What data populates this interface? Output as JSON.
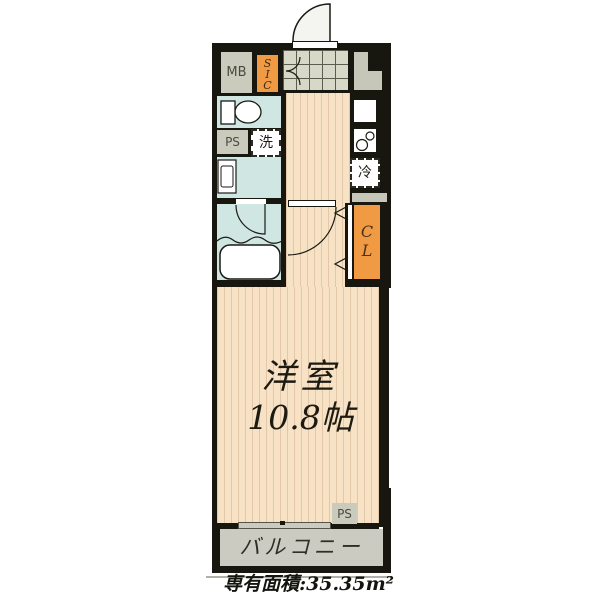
{
  "title": "floor-plan",
  "labels": {
    "mb": "MB",
    "sic": "SIC",
    "sic_letters": [
      "S",
      "I",
      "C"
    ],
    "ps_top": "PS",
    "laundry": "洗",
    "fridge": "冷",
    "cl": "CL",
    "cl_letters": [
      "C",
      "L"
    ],
    "room_name": "洋室",
    "room_size": "10.8帖",
    "ps_bottom": "PS",
    "balcony": "バルコニー",
    "area_note": "専有面積:35.35m²"
  },
  "colors": {
    "wall": "#17170f",
    "floor": "#f8e2c6",
    "floor_stripe": "#e3c7a9",
    "wet_area": "#cfe6e2",
    "closet_orange": "#f09a44",
    "service_gray": "#cbcbbd",
    "entry_tile": "#d8d8c9",
    "balcony_gray": "#cbcbc1",
    "fixture_white": "#ffffff"
  }
}
